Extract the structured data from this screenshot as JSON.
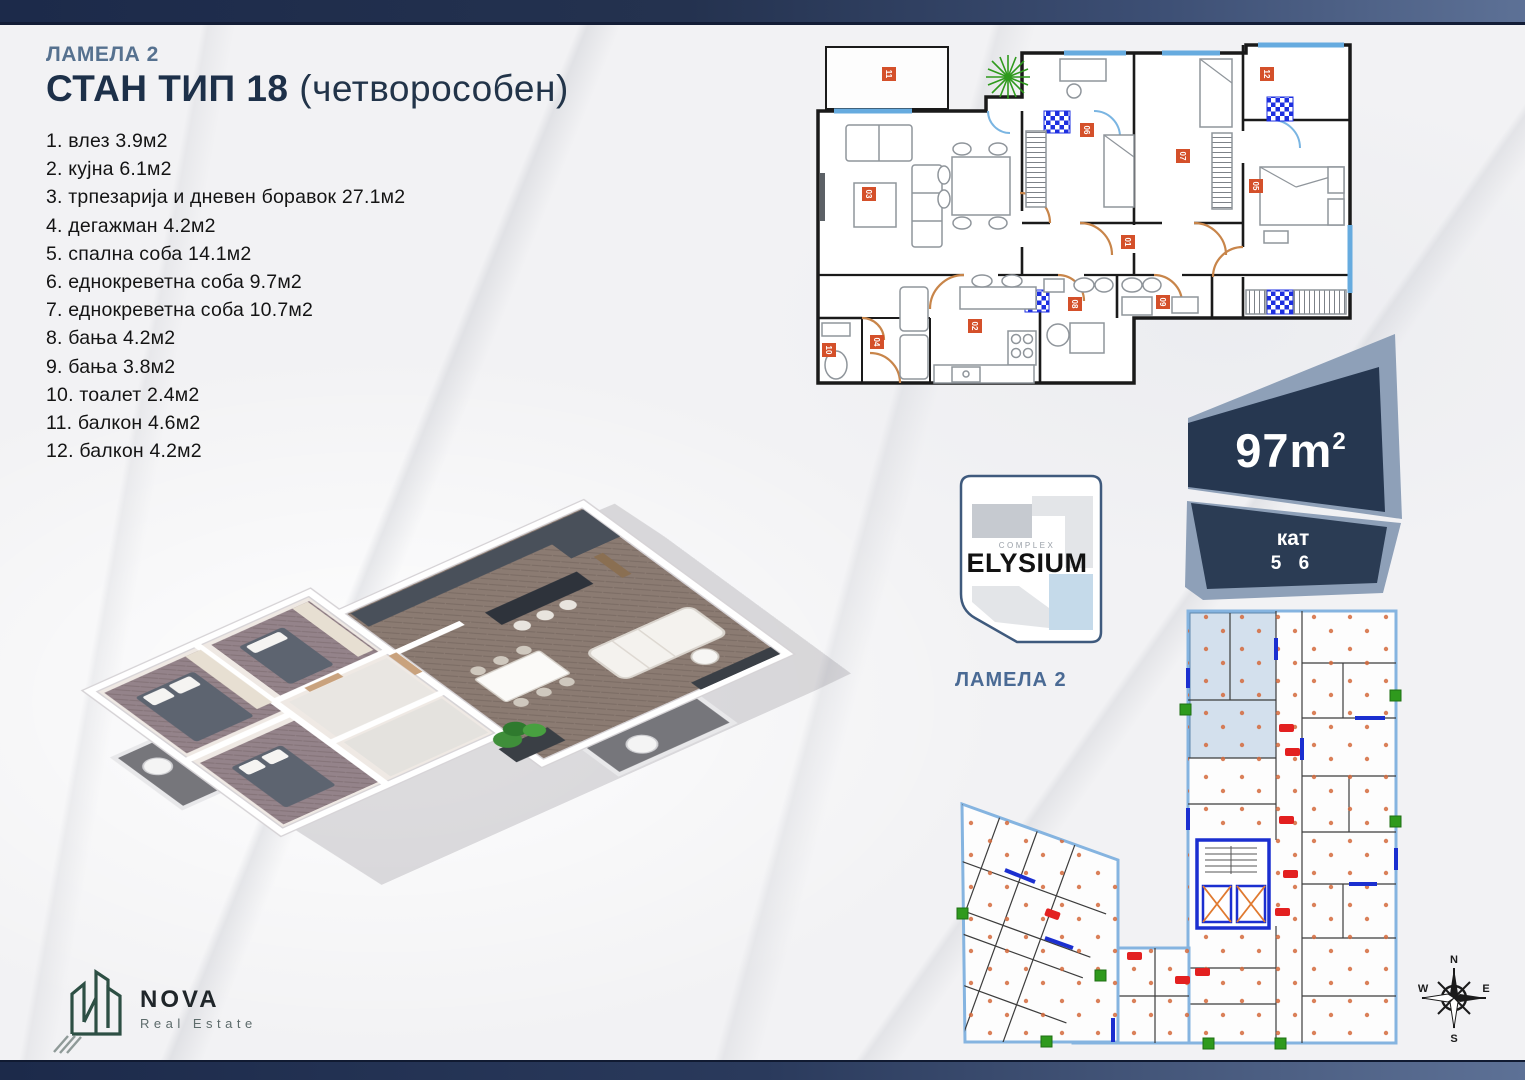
{
  "header": {
    "lamela": "ЛАМЕЛА 2",
    "title": "СТАН ТИП 18",
    "subtitle": "(четворособен)"
  },
  "rooms": [
    {
      "num": "1.",
      "name": "влез",
      "area": "3.9м2",
      "text": "1. влез 3.9м2"
    },
    {
      "num": "2.",
      "name": "кујна",
      "area": "6.1м2",
      "text": "2. кујна 6.1м2"
    },
    {
      "num": "3.",
      "name": "трпезарија и дневен боравок",
      "area": "27.1м2",
      "text": "3. трпезарија и дневен боравок 27.1м2"
    },
    {
      "num": "4.",
      "name": "дегажман",
      "area": "4.2м2",
      "text": "4. дегажман 4.2м2"
    },
    {
      "num": "5.",
      "name": "спална соба",
      "area": "14.1м2",
      "text": "5. спална соба 14.1м2"
    },
    {
      "num": "6.",
      "name": "еднокреветна соба",
      "area": "9.7м2",
      "text": "6. еднокреветна соба 9.7м2"
    },
    {
      "num": "7.",
      "name": "еднокреветна соба",
      "area": "10.7м2",
      "text": "7. еднокреветна соба 10.7м2"
    },
    {
      "num": "8.",
      "name": "бања",
      "area": "4.2м2",
      "text": "8. бања 4.2м2"
    },
    {
      "num": "9.",
      "name": "бања",
      "area": "3.8м2",
      "text": "9. бања 3.8м2"
    },
    {
      "num": "10.",
      "name": "тоалет",
      "area": "2.4м2",
      "text": "10. тоалет 2.4м2"
    },
    {
      "num": "11.",
      "name": "балкон",
      "area": "4.6м2",
      "text": "11. балкон 4.6м2"
    },
    {
      "num": "12.",
      "name": "балкон",
      "area": "4.2м2",
      "text": "12. балкон 4.2м2"
    }
  ],
  "badge": {
    "area_value": "97m",
    "area_exp": "2",
    "floor_label": "кат",
    "floors_text": "5 6",
    "floors": [
      5,
      6
    ]
  },
  "elysium": {
    "complex_label": "COMPLEX",
    "name": "ELYSIUM",
    "lamela_label": "ЛАМЕЛА 2"
  },
  "plan2d": {
    "markers": [
      "01",
      "02",
      "03",
      "04",
      "05",
      "06",
      "07",
      "08",
      "09",
      "10",
      "11",
      "12"
    ]
  },
  "nova": {
    "name": "NOVA",
    "tagline": "Real Estate"
  },
  "compass": {
    "n": "N",
    "e": "E",
    "s": "S",
    "w": "W"
  },
  "colors": {
    "bar_navy": "#1c2a4a",
    "title_navy": "#1d3049",
    "lamela_blue": "#56718f",
    "badge_navy": "#263750",
    "badge_edge": "#8ea0b8",
    "window_blue": "#66abdf",
    "door_tan": "#c8854a",
    "marker_red": "#d4502a",
    "shaft_blue": "#1d2fe0",
    "plan_outline_blue": "#85b4e0",
    "highlight_unit_blue": "#b9cfe3",
    "plant_green": "#2f9a1d",
    "nova_green": "#2d4f44"
  }
}
